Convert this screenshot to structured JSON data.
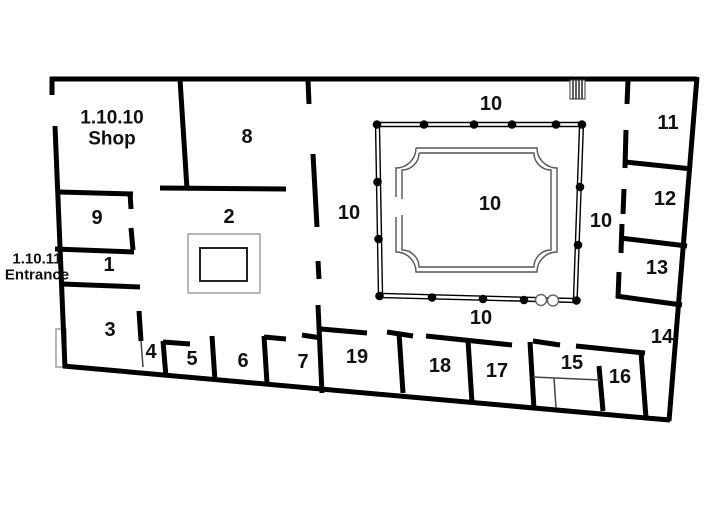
{
  "labels": {
    "shop_id": "1.10.10",
    "shop_name": "Shop",
    "entrance_id": "1.10.11",
    "entrance_name": "Entrance",
    "rooms": {
      "r1": "1",
      "r2": "2",
      "r3": "3",
      "r4": "4",
      "r5": "5",
      "r6": "6",
      "r7": "7",
      "r8": "8",
      "r9": "9",
      "r11": "11",
      "r12": "12",
      "r13": "13",
      "r14": "14",
      "r15": "15",
      "r16": "16",
      "r17": "17",
      "r18": "18",
      "r19": "19"
    },
    "courtyard": "10",
    "corridor_top": "10",
    "corridor_left": "10",
    "corridor_right": "10",
    "corridor_bottom": "10"
  },
  "symbols": {
    "column": "filled-circle-column",
    "column_base": "open-circle-column",
    "stairs": "stairs-hatch",
    "blocked_door": "door-threshold-rect"
  },
  "colors": {
    "wall": "#000000",
    "thin_line": "#444444",
    "light_line": "#999999",
    "background": "#ffffff"
  }
}
